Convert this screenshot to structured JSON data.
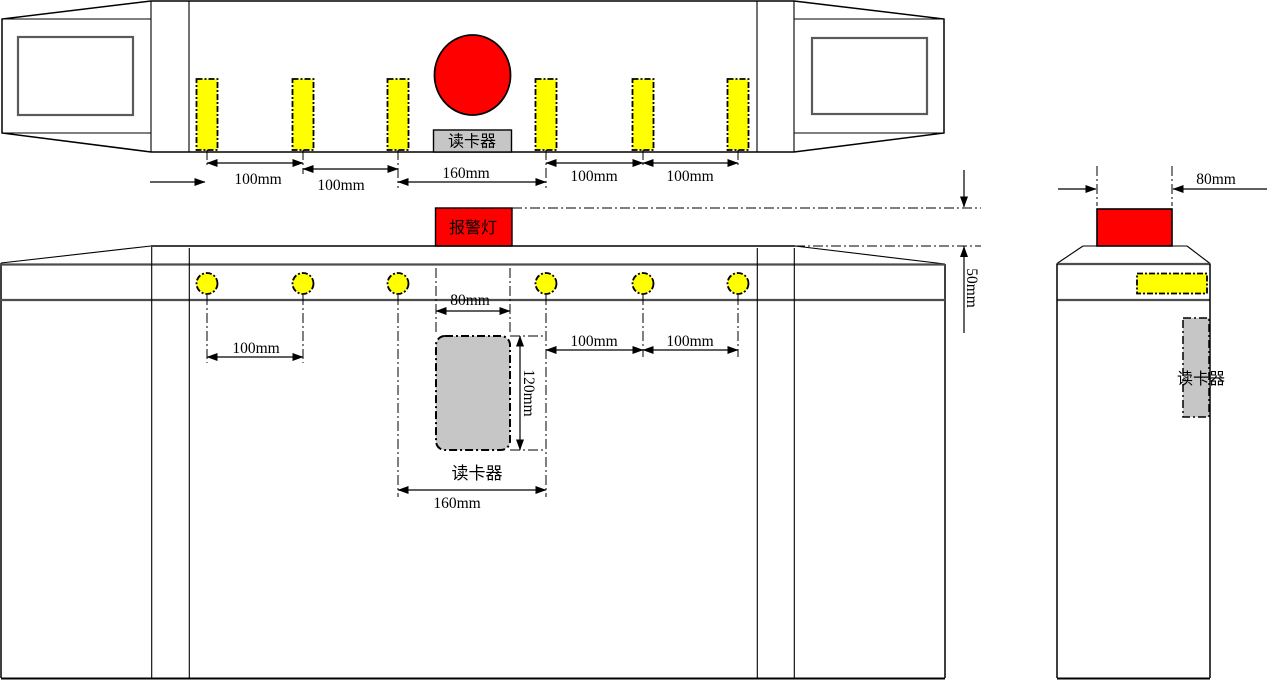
{
  "drawing": {
    "colors": {
      "led_yellow": "#ffff00",
      "alarm_red": "#ff0000",
      "reader_gray": "#c6c6c6",
      "band_gray": "#4d4d4d"
    },
    "top_view": {
      "reader_label": "读卡器",
      "dims": [
        "100mm",
        "100mm",
        "160mm",
        "100mm",
        "100mm"
      ]
    },
    "alarm_projection": {
      "alarm_label": "报警灯",
      "offset_dim": "50mm"
    },
    "front_view": {
      "reader_label": "读卡器",
      "dim_spacing_left": "100mm",
      "reader_width_dim": "80mm",
      "reader_height_dim": "120mm",
      "dim_spacing_right1": "100mm",
      "dim_spacing_right2": "100mm",
      "reader_span_dim": "160mm"
    },
    "side_view": {
      "reader_label": "读卡器",
      "alarm_width_dim": "80mm"
    }
  }
}
